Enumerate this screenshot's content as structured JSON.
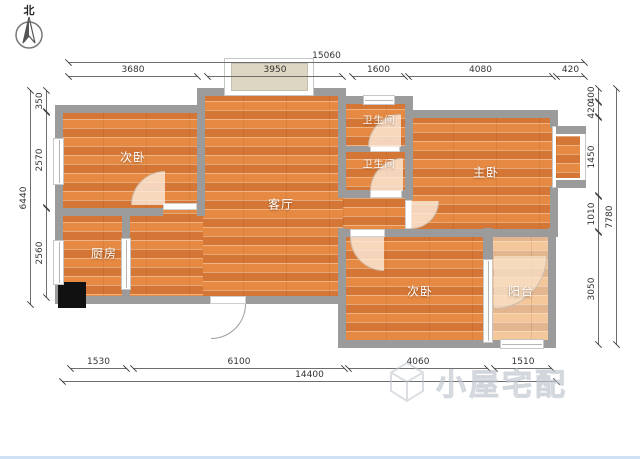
{
  "compass": {
    "north_label": "北"
  },
  "rooms": {
    "bedroom_upper_left": "次卧",
    "living_room": "客厅",
    "bathroom_upper": "卫生间",
    "bathroom_lower": "卫生间",
    "master_bedroom": "主卧",
    "kitchen": "厨房",
    "bedroom_lower_right": "次卧",
    "balcony": "阳台"
  },
  "dimensions": {
    "top": {
      "total": "15060",
      "segments": [
        "3680",
        "3950",
        "1600",
        "4080",
        "420"
      ]
    },
    "bottom": {
      "total": "14400",
      "segments": [
        "1530",
        "6100",
        "4060",
        "1510"
      ]
    },
    "left": {
      "total": "6440",
      "segments": [
        "350",
        "2570",
        "2560"
      ]
    },
    "right": {
      "total": "7780",
      "segments": [
        "400",
        "420",
        "1450",
        "1010",
        "3050"
      ]
    }
  },
  "watermark": {
    "text": "小屋宅配"
  },
  "colors": {
    "wall": "#9b9b9b",
    "wood_floor": "#e0813c",
    "balcony_floor": "#f2cda9",
    "dimension_line": "#6e6e6e",
    "watermark": "#bcc3cb",
    "bottom_edge": "#cfe2f4"
  }
}
